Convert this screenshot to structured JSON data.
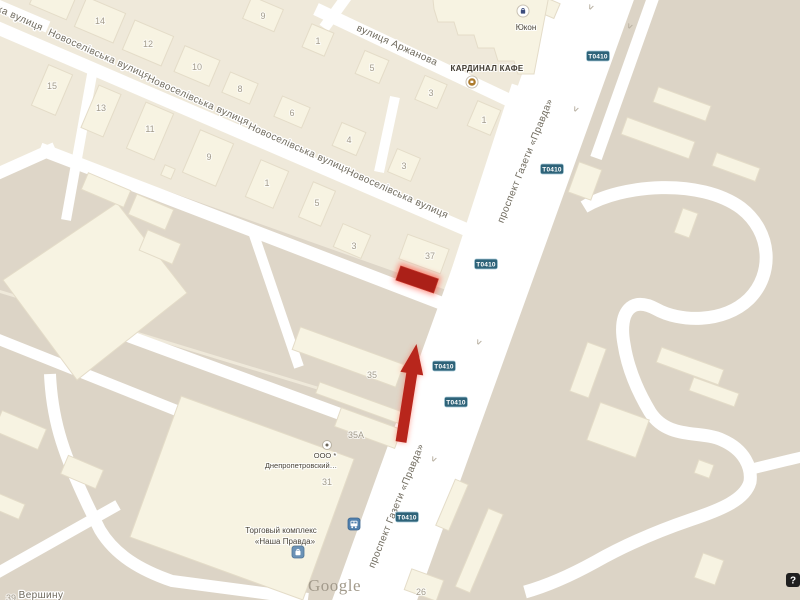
{
  "map": {
    "attribution": {
      "logo": "Google"
    },
    "help_label": "?",
    "street_labels": [
      {
        "text": "ка вулиця",
        "x": 19,
        "y": 21,
        "rot": 24
      },
      {
        "text": "Новоселівська вулиця",
        "x": 98,
        "y": 57,
        "rot": 24
      },
      {
        "text": "Новоселівська вулиця",
        "x": 197,
        "y": 103,
        "rot": 24
      },
      {
        "text": "Новоселівська вулиця",
        "x": 298,
        "y": 151,
        "rot": 24
      },
      {
        "text": "Новоселівська вулиця",
        "x": 396,
        "y": 196,
        "rot": 24
      },
      {
        "text": "вулиця Аржанова",
        "x": 396,
        "y": 48,
        "rot": 24
      },
      {
        "text": "проспект Газети «Правда»",
        "x": 528,
        "y": 162,
        "rot": -68
      },
      {
        "text": "проспект Газети «Правда»",
        "x": 399,
        "y": 507,
        "rot": -68
      },
      {
        "text": "Вершину",
        "x": 41,
        "y": 598,
        "rot": 0
      }
    ],
    "route_badges": {
      "text": "T0410",
      "positions": [
        {
          "x": 598,
          "y": 56
        },
        {
          "x": 552,
          "y": 169
        },
        {
          "x": 486,
          "y": 264
        },
        {
          "x": 444,
          "y": 366
        },
        {
          "x": 456,
          "y": 402
        },
        {
          "x": 407,
          "y": 517
        }
      ]
    },
    "building_numbers": [
      {
        "n": "9",
        "x": 263,
        "y": 16
      },
      {
        "n": "14",
        "x": 100,
        "y": 21
      },
      {
        "n": "12",
        "x": 148,
        "y": 44
      },
      {
        "n": "10",
        "x": 197,
        "y": 67
      },
      {
        "n": "8",
        "x": 240,
        "y": 89
      },
      {
        "n": "6",
        "x": 292,
        "y": 113
      },
      {
        "n": "15",
        "x": 52,
        "y": 86
      },
      {
        "n": "13",
        "x": 101,
        "y": 108
      },
      {
        "n": "11",
        "x": 150,
        "y": 129
      },
      {
        "n": "9",
        "x": 209,
        "y": 157
      },
      {
        "n": "1",
        "x": 267,
        "y": 183
      },
      {
        "n": "1",
        "x": 318,
        "y": 41
      },
      {
        "n": "5",
        "x": 372,
        "y": 68
      },
      {
        "n": "3",
        "x": 431,
        "y": 93
      },
      {
        "n": "1",
        "x": 484,
        "y": 120
      },
      {
        "n": "4",
        "x": 349,
        "y": 140
      },
      {
        "n": "3",
        "x": 404,
        "y": 166
      },
      {
        "n": "5",
        "x": 317,
        "y": 203
      },
      {
        "n": "3",
        "x": 354,
        "y": 246
      },
      {
        "n": "37",
        "x": 430,
        "y": 256
      },
      {
        "n": "35",
        "x": 372,
        "y": 375
      },
      {
        "n": "35А",
        "x": 356,
        "y": 435
      },
      {
        "n": "31",
        "x": 327,
        "y": 482
      },
      {
        "n": "26",
        "x": 421,
        "y": 592
      },
      {
        "n": "39",
        "x": 11,
        "y": 598
      }
    ],
    "one_way_arrows": [
      {
        "x": 588,
        "y": 6
      },
      {
        "x": 627,
        "y": 25
      },
      {
        "x": 573,
        "y": 108
      },
      {
        "x": 476,
        "y": 341
      },
      {
        "x": 431,
        "y": 458
      }
    ],
    "pois": {
      "yukon": {
        "label": "Юкон"
      },
      "cafe": {
        "label": "КАРДИНАЛ КАФЕ"
      },
      "company": {
        "line1": "ООО *",
        "line2": "Днепропетровский…"
      },
      "mall": {
        "line1": "Торговый комплекс",
        "line2": "«Наша Правда»"
      }
    },
    "markers": {
      "highlight_rectangle": {
        "x": 417,
        "y": 280,
        "color": "#ab2018"
      },
      "direction_arrow": {
        "tip_x": 416,
        "tip_y": 344,
        "color": "#b8261c"
      }
    },
    "colors": {
      "road": "#ffffff",
      "block_light": "#efe9da",
      "block_mid": "#e7e0d0",
      "block_dark": "#dcd4c6",
      "building": "#f7f3e2",
      "badge_bg": "#2e6379",
      "street_label": "#6f6a5d",
      "marker_red": "#ab2018"
    }
  }
}
